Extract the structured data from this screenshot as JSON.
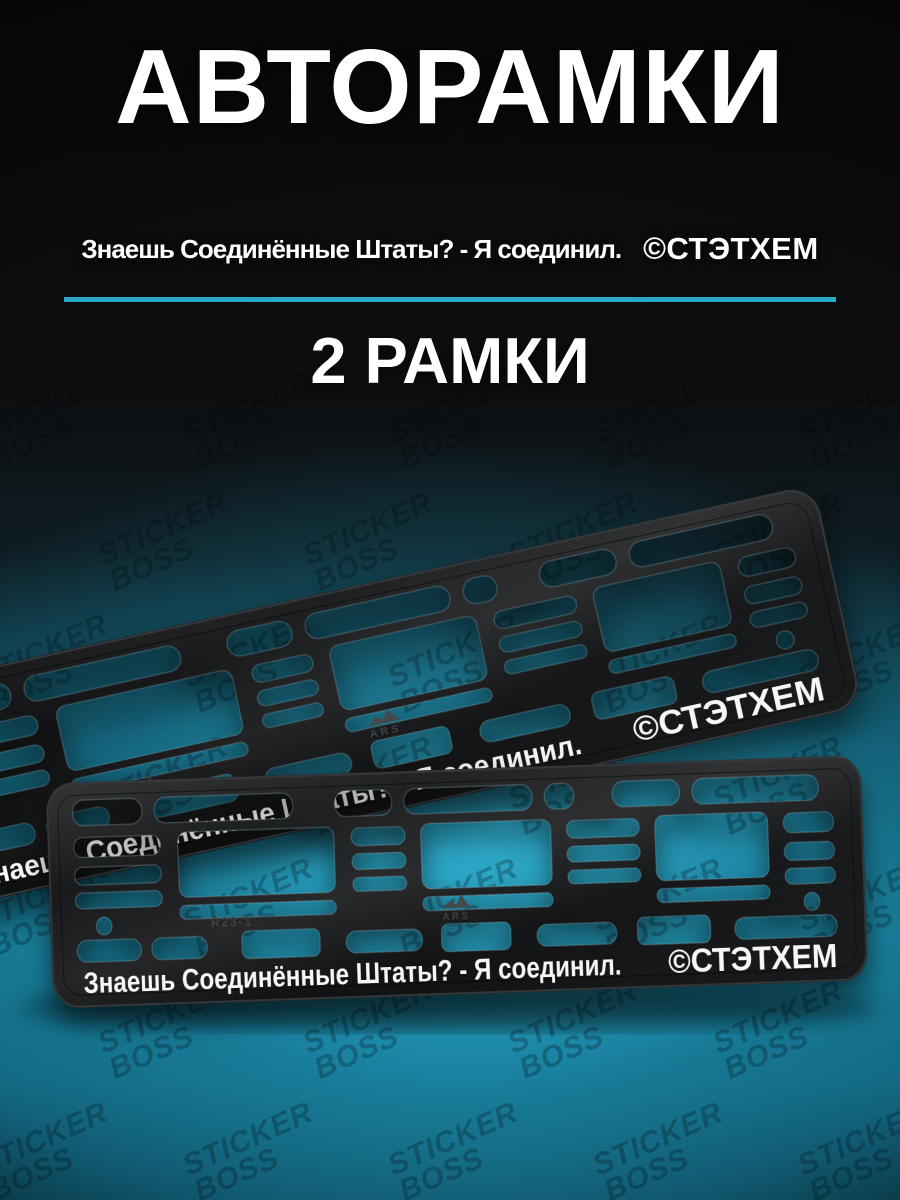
{
  "header": {
    "title": "АВТОРАМКИ",
    "quote": "Знаешь Соединённые Штаты? - Я соединил.",
    "brand": "©СТЭТХЕМ",
    "count": "2 РАМКИ"
  },
  "frame_print": {
    "quote": "Знаешь Соединённые Штаты? - Я соединил.",
    "brand": "©СТЭТХЕМ",
    "mold_code": "R23-1",
    "mold_logo": "ARS"
  },
  "watermark": {
    "text": "STICKER BOSS"
  },
  "colors": {
    "accent_line": "#2aa9c8",
    "glow_teal": "#1f93b3",
    "background_dark": "#0d0e10",
    "frame_black": "#141517",
    "text_white": "#ffffff"
  }
}
